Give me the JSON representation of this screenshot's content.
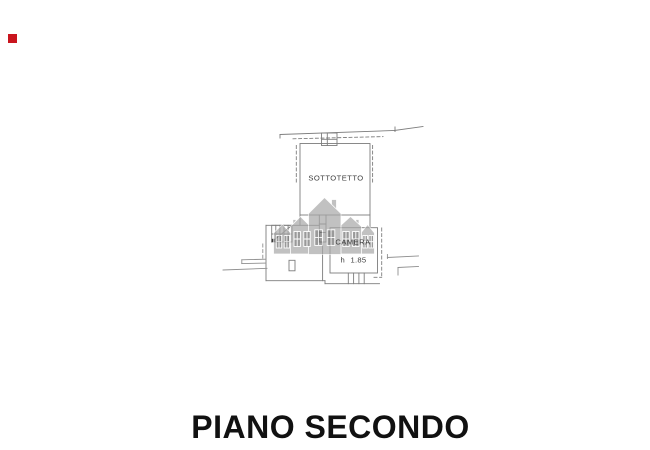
{
  "page": {
    "background": "#ffffff"
  },
  "marker": {
    "color": "#c9151e",
    "css": "background:#c9151e"
  },
  "title": {
    "text": "PIANO SECONDO",
    "color": "#111111"
  },
  "plan": {
    "line_color": "#7d7d7d",
    "light_line_color": "#8f8f8f",
    "labels": {
      "sottotetto": "SOTTOTETTO",
      "camera": "CAMERA",
      "camera_height": "h 1.85"
    },
    "watermark": {
      "name": "houses-watermark",
      "body_color": "#a8a8a8",
      "window_color": "#6e6e6e"
    }
  }
}
